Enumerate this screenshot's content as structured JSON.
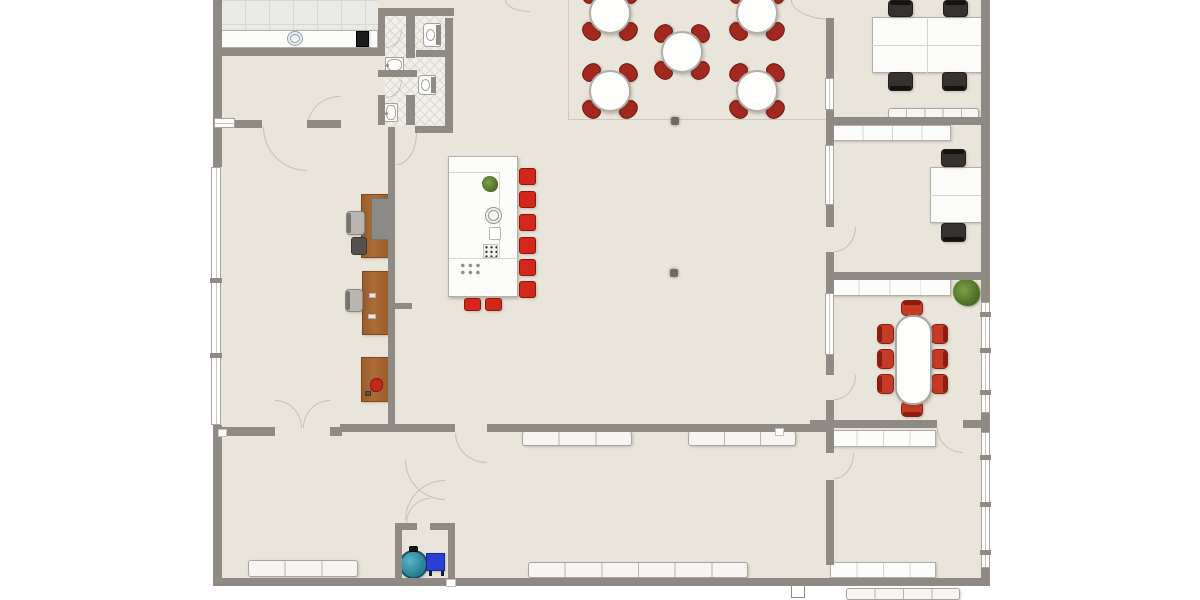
{
  "app": {
    "type": "floor-plan-viewer",
    "description": "2D top-down floor plan, no visible text labels"
  },
  "palette": {
    "floor": "#e9e5da",
    "wall": "#8f8a84",
    "arc_line": "#c6c1b7",
    "faint_line": "#cdc9c0",
    "window_fill": "#ffffff",
    "window_border": "#a8a49e",
    "window_tick": "#8f8a84",
    "white_furniture": "#fcfcfa",
    "furniture_border": "#b3afa8",
    "divider": "#d6d3cd",
    "radiator_fill": "#f6f5f2",
    "radiator_line": "#b8b4ae",
    "dining_chair": "#a3281f",
    "dining_chair_border": "#6f130d",
    "stool": "#d3271b",
    "stool_border": "#8e170d",
    "conference_chair": "#c63a28",
    "conference_chair_border": "#8c1d10",
    "wood_desk": "#a2622f",
    "wood_desk_border": "#7d4a20",
    "desk_return_gray": "#8c8a87",
    "black_chair": "#36322f",
    "black_chair_border": "#211e1c",
    "gray_chair": "#b9b6b1",
    "gray_chair_border": "#8b8884",
    "dark_chair": "#55504b",
    "tank_teal": "#2d8396",
    "tank_border": "#155663",
    "electric_box_blue": "#2b3fd4",
    "electric_box_border": "#1a2a9e",
    "plant_green": "#4e7327",
    "appliance_black": "#1c1c1c",
    "column": "#6f6a64",
    "fixture_border": "#a5a19b"
  },
  "plan": {
    "floors": {
      "main": [
        213,
        0,
        777,
        586
      ],
      "tile": [
        221,
        0,
        157,
        48
      ],
      "hatch": [
        385,
        15,
        60,
        110
      ]
    },
    "faint_lines": [
      [
        568,
        0,
        1,
        119
      ],
      [
        568,
        119,
        259,
        1
      ]
    ],
    "arcs": [
      [
        307,
        96,
        33,
        31,
        "tl"
      ],
      [
        263,
        127,
        44,
        44,
        "bl"
      ],
      [
        396,
        133,
        21,
        32,
        "br"
      ],
      [
        505,
        0,
        25,
        12,
        "bl"
      ],
      [
        791,
        0,
        42,
        20,
        "bl"
      ],
      [
        834,
        227,
        22,
        25,
        "br"
      ],
      [
        834,
        375,
        22,
        25,
        "br"
      ],
      [
        834,
        453,
        20,
        26,
        "br"
      ],
      [
        275,
        400,
        27,
        28,
        "tr"
      ],
      [
        303,
        400,
        27,
        28,
        "tl"
      ],
      [
        455,
        433,
        32,
        30,
        "bl"
      ],
      [
        406,
        498,
        24,
        26,
        "tl"
      ],
      [
        405,
        460,
        40,
        40,
        "bl"
      ],
      [
        405,
        480,
        40,
        40,
        "tl"
      ],
      [
        937,
        428,
        26,
        25,
        "bl"
      ],
      [
        386,
        30,
        16,
        18,
        "br"
      ],
      [
        386,
        80,
        16,
        18,
        "br"
      ]
    ],
    "walls": [
      [
        213,
        0,
        9,
        167
      ],
      [
        213,
        425,
        9,
        161
      ],
      [
        213,
        578,
        777,
        8
      ],
      [
        981,
        0,
        9,
        302
      ],
      [
        981,
        413,
        9,
        19
      ],
      [
        981,
        568,
        9,
        18
      ],
      [
        213,
        48,
        172,
        8
      ],
      [
        378,
        8,
        76,
        8
      ],
      [
        445,
        18,
        8,
        115
      ],
      [
        378,
        16,
        7,
        40
      ],
      [
        378,
        95,
        7,
        30
      ],
      [
        406,
        16,
        9,
        42
      ],
      [
        378,
        70,
        39,
        7
      ],
      [
        406,
        95,
        9,
        30
      ],
      [
        416,
        50,
        37,
        7
      ],
      [
        415,
        126,
        37,
        7
      ],
      [
        234,
        120,
        28,
        8
      ],
      [
        307,
        120,
        34,
        8
      ],
      [
        388,
        127,
        7,
        301
      ],
      [
        395,
        303,
        17,
        6
      ],
      [
        213,
        427,
        62,
        9
      ],
      [
        330,
        427,
        12,
        9
      ],
      [
        340,
        424,
        115,
        8
      ],
      [
        487,
        424,
        339,
        8
      ],
      [
        395,
        523,
        7,
        57
      ],
      [
        395,
        523,
        22,
        7
      ],
      [
        430,
        523,
        25,
        7
      ],
      [
        448,
        523,
        7,
        57
      ],
      [
        826,
        18,
        8,
        60
      ],
      [
        826,
        110,
        8,
        35
      ],
      [
        826,
        205,
        8,
        22
      ],
      [
        826,
        252,
        8,
        20
      ],
      [
        826,
        117,
        164,
        8
      ],
      [
        826,
        272,
        164,
        8
      ],
      [
        826,
        280,
        8,
        13
      ],
      [
        826,
        355,
        8,
        20
      ],
      [
        826,
        400,
        8,
        23
      ],
      [
        810,
        420,
        127,
        8
      ],
      [
        963,
        420,
        27,
        8
      ],
      [
        826,
        428,
        8,
        25
      ],
      [
        826,
        480,
        8,
        85
      ]
    ],
    "windows": [
      {
        "rect": [
          211,
          167,
          10,
          258
        ],
        "ticks": [
          278,
          353
        ]
      },
      {
        "rect": [
          214,
          118,
          21,
          10
        ],
        "ticks": []
      },
      {
        "rect": [
          981,
          302,
          9,
          111
        ],
        "ticks": [
          312,
          348,
          390
        ]
      },
      {
        "rect": [
          981,
          432,
          9,
          136
        ],
        "ticks": [
          455,
          502,
          550
        ]
      },
      {
        "rect": [
          825,
          78,
          9,
          32
        ],
        "ticks": []
      },
      {
        "rect": [
          825,
          145,
          9,
          60
        ],
        "ticks": []
      },
      {
        "rect": [
          825,
          293,
          9,
          62
        ],
        "ticks": []
      }
    ],
    "junctions": [
      [
        218,
        429,
        9,
        8
      ],
      [
        775,
        428,
        9,
        8
      ],
      [
        446,
        579,
        10,
        8
      ]
    ],
    "columns": [
      [
        671,
        117,
        8,
        8
      ],
      [
        670,
        269,
        8,
        8
      ]
    ],
    "kitchen": {
      "counter": [
        221,
        30,
        157,
        18
      ],
      "sink": [
        287,
        31,
        16,
        15
      ],
      "appliance": [
        356,
        31,
        13,
        16
      ]
    },
    "bathroom": {
      "toilets": [
        [
          423,
          23,
          18,
          24
        ],
        [
          418,
          75,
          18,
          20
        ]
      ],
      "sinks": [
        [
          385,
          57,
          19,
          16
        ],
        [
          384,
          103,
          14,
          19
        ]
      ]
    },
    "dining": {
      "tables": [
        [
          610,
          13
        ],
        [
          682,
          52
        ],
        [
          610,
          91
        ],
        [
          757,
          13
        ],
        [
          757,
          91
        ]
      ],
      "table_diameter": 42,
      "chair_offset": 27,
      "chairs_per_table": 4
    },
    "island": {
      "rect": [
        448,
        156,
        70,
        141
      ],
      "inner_lines": [
        [
          499,
          172,
          1,
          86
        ],
        [
          449,
          258,
          69,
          1
        ],
        [
          449,
          172,
          50,
          1
        ]
      ],
      "plant": [
        482,
        176,
        16,
        16
      ],
      "sink": [
        485,
        207,
        17,
        17
      ],
      "tray": [
        489,
        227,
        12,
        13
      ],
      "stove": [
        483,
        244,
        15,
        14
      ],
      "burners": [
        459,
        262,
        23,
        14
      ],
      "stool_size": 17,
      "stools_right": [
        [
          519,
          168
        ],
        [
          519,
          191
        ],
        [
          519,
          214
        ],
        [
          519,
          237
        ],
        [
          519,
          259
        ],
        [
          519,
          281
        ]
      ],
      "stools_bottom": [
        [
          464,
          298,
          17,
          13
        ],
        [
          485,
          298,
          17,
          13
        ]
      ]
    },
    "reception": {
      "desks": [
        [
          361,
          194,
          28,
          64
        ],
        [
          362,
          271,
          27,
          64
        ],
        [
          361,
          357,
          28,
          45
        ]
      ],
      "desk_return": [
        371,
        198,
        18,
        42
      ],
      "gray_chairs": [
        [
          346,
          211,
          19,
          24
        ],
        [
          345,
          289,
          18,
          23
        ]
      ],
      "dark_chair": [
        351,
        237,
        16,
        18
      ],
      "desk_items_light": [
        [
          369,
          293,
          7,
          5
        ],
        [
          368,
          314,
          8,
          5
        ]
      ],
      "desk_item_red": [
        370,
        378,
        13,
        14
      ],
      "desk_item_dark": [
        365,
        391,
        6,
        5
      ]
    },
    "offices": {
      "cluster1": {
        "rect": [
          872,
          17,
          110,
          56
        ],
        "vdiv": 927,
        "hdiv": 45
      },
      "cluster2": {
        "rect": [
          930,
          167,
          52,
          56
        ],
        "hdiv": 195
      },
      "black_chairs": [
        [
          888,
          0,
          25,
          17,
          "top"
        ],
        [
          943,
          0,
          25,
          17,
          "top"
        ],
        [
          888,
          72,
          25,
          19,
          "bottom"
        ],
        [
          942,
          72,
          25,
          19,
          "bottom"
        ],
        [
          941,
          149,
          25,
          18,
          "top"
        ],
        [
          941,
          223,
          25,
          19,
          "bottom"
        ]
      ]
    },
    "conference": {
      "table": [
        895,
        315,
        37,
        90
      ],
      "chairs": [
        [
          877,
          324,
          17,
          20,
          "left"
        ],
        [
          877,
          349,
          17,
          20,
          "left"
        ],
        [
          877,
          374,
          17,
          20,
          "left"
        ],
        [
          931,
          324,
          17,
          20,
          "right"
        ],
        [
          931,
          349,
          17,
          20,
          "right"
        ],
        [
          931,
          374,
          17,
          20,
          "right"
        ],
        [
          901,
          300,
          22,
          16,
          "top"
        ],
        [
          901,
          401,
          22,
          16,
          "bottom"
        ]
      ]
    },
    "cabinets": [
      [
        833,
        125,
        118,
        16,
        4
      ],
      [
        828,
        279,
        123,
        17,
        4
      ],
      [
        830,
        430,
        106,
        17,
        4
      ],
      [
        830,
        562,
        106,
        16,
        4
      ]
    ],
    "radiators": [
      [
        522,
        431,
        110,
        15,
        3
      ],
      [
        688,
        431,
        108,
        15,
        3
      ],
      [
        528,
        562,
        220,
        16,
        6
      ],
      [
        248,
        560,
        110,
        17,
        3
      ],
      [
        888,
        108,
        91,
        13,
        5
      ],
      [
        846,
        588,
        114,
        12,
        4
      ]
    ],
    "plants": [
      [
        953,
        279,
        27,
        27
      ]
    ],
    "utility": {
      "tank": [
        399,
        550,
        29,
        29
      ],
      "tank_cap": [
        409,
        546,
        9,
        6
      ],
      "box": [
        426,
        553,
        19,
        18
      ],
      "box_legs": [
        [
          429,
          571,
          3,
          5
        ],
        [
          441,
          571,
          3,
          5
        ]
      ]
    },
    "exit_door": [
      791,
      585,
      14,
      13
    ]
  }
}
